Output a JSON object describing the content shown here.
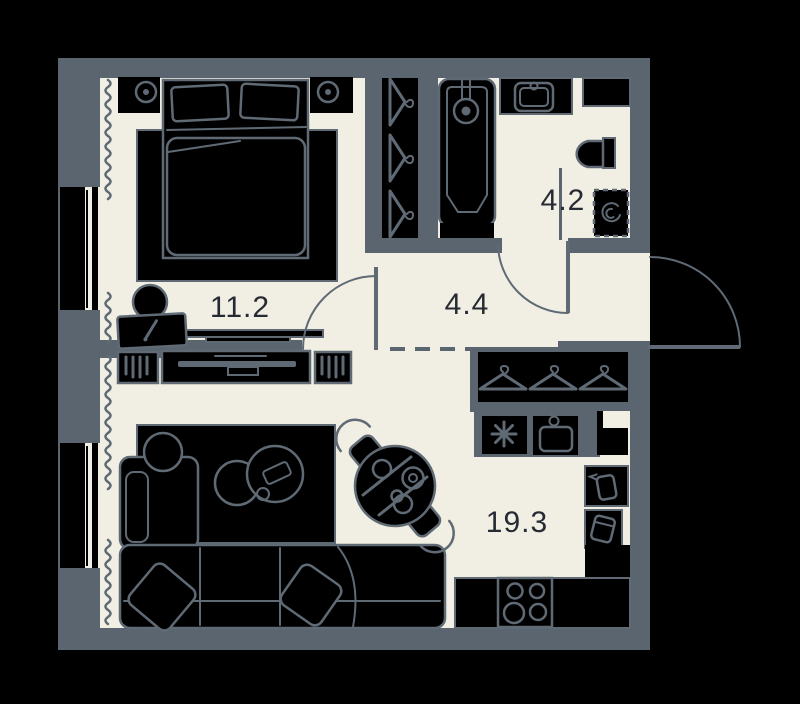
{
  "title": "apartment-floor-plan",
  "labels": {
    "bedroom": "11.2",
    "bathroom": "4.2",
    "hallway": "4.4",
    "living_kitchen": "19.3"
  },
  "rooms": [
    {
      "name": "bedroom",
      "area": "11.2"
    },
    {
      "name": "bathroom",
      "area": "4.2"
    },
    {
      "name": "hallway",
      "area": "4.4"
    },
    {
      "name": "living-kitchen",
      "area": "19.3"
    }
  ],
  "colors": {
    "background": "#000000",
    "wall": "#5b6570",
    "floor": "#f1eee3",
    "furniture_fill": "#000000",
    "outline": "#5f6a75",
    "label_text": "#262b33"
  },
  "icons": [
    "lamp-icon",
    "pen-icon",
    "hanger-icon",
    "faucet-icon",
    "sink-icon",
    "toilet-icon",
    "washing-machine-icon",
    "spiral-icon",
    "snowflake-icon",
    "stove-burners-icon",
    "kettle-icon",
    "container-icon",
    "tv-icon",
    "radiator-slats-icon",
    "curtain-squiggle",
    "door-swing-arc",
    "window-glazing"
  ]
}
